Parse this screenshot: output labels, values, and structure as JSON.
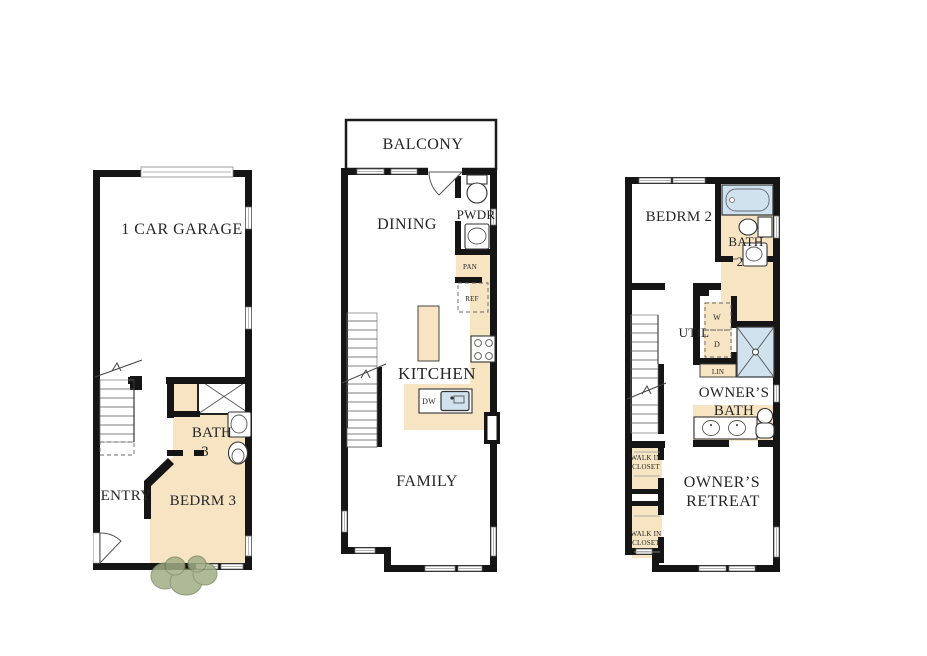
{
  "document": {
    "title": "Three-story townhome floor plan"
  },
  "colors": {
    "wall": "#151515",
    "floor_fill": "#f6e4c2",
    "fixture_blue": "#cfe2ee",
    "bush_green": "#a3ad85",
    "bush_outline": "#7d885e",
    "text": "#252525"
  },
  "first_floor": {
    "garage": "1 CAR GARAGE",
    "entry": "ENTRY",
    "bedroom": "BEDRM 3",
    "bath_line1": "BATH",
    "bath_line2": "3"
  },
  "second_floor": {
    "balcony": "BALCONY",
    "dining": "DINING",
    "powder": "PWDR",
    "pantry": "PAN",
    "refrigerator": "REF",
    "kitchen": "KITCHEN",
    "dishwasher": "DW",
    "family": "FAMILY"
  },
  "third_floor": {
    "bedroom": "BEDRM 2",
    "bath_line1": "BATH",
    "bath_line2": "2",
    "utility": "UTIL",
    "washer": "W",
    "dryer": "D",
    "linen": "LIN",
    "owners_bath_line1": "OWNER’S",
    "owners_bath_line2": "BATH",
    "walk_in_line1": "WALK IN",
    "walk_in_line2": "CLOSET",
    "retreat_line1": "OWNER’S",
    "retreat_line2": "RETREAT"
  }
}
